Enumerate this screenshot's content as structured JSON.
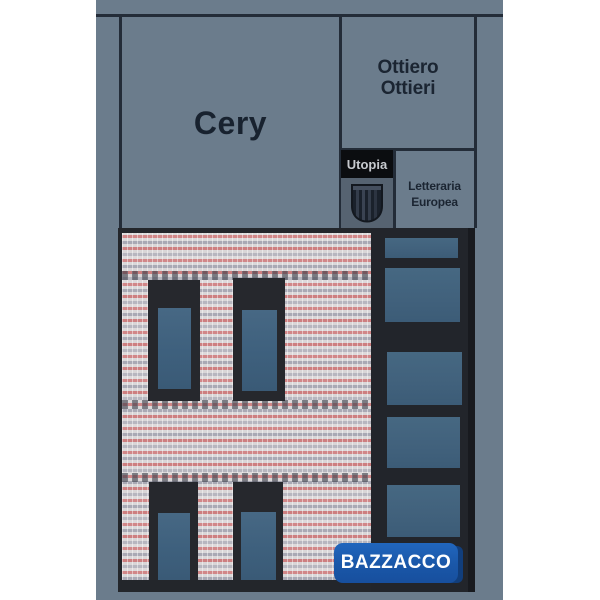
{
  "cover": {
    "title": "Cery",
    "author": {
      "line1": "Ottiero",
      "line2": "Ottieri"
    },
    "series": {
      "name": "Utopia",
      "subtitle_line1": "Letteraria",
      "subtitle_line2": "Europea",
      "logo_icon": "publisher-shield-icon"
    },
    "colors": {
      "background": "#6b7c8c",
      "frame_lines": "#232c38",
      "text": "#1b2532",
      "series_box_bg": "#0b0d10",
      "series_box_text": "#c7cacf",
      "logo_box_bg": "#566371"
    }
  },
  "artwork": {
    "subject": "brick-building-facade",
    "colors": {
      "brick_light": "#d9d6d7",
      "brick_gray": "#a9a9b4",
      "brick_pink": "#d18788",
      "window_frame": "#26282d",
      "window_pane": "#3f617d",
      "dark_strip": "#22252b"
    }
  },
  "badge": {
    "label": "BAZZACCO",
    "colors": {
      "front": "#1a57a8",
      "back": "#113e7c",
      "text": "#ffffff"
    }
  }
}
